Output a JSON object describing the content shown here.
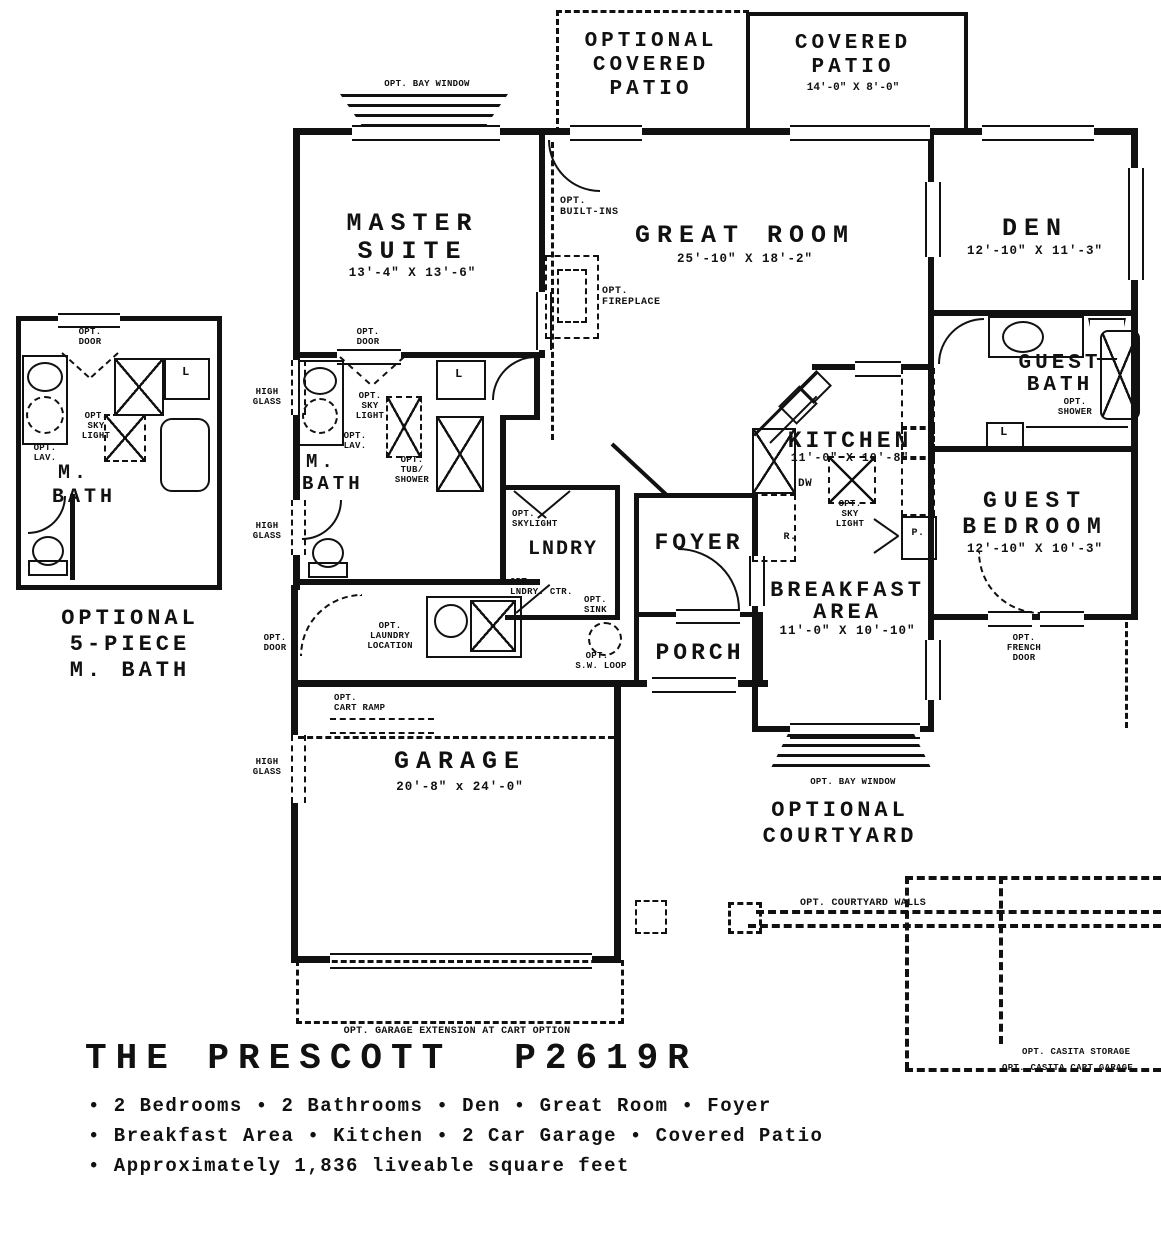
{
  "patios": {
    "optional": [
      "OPTIONAL",
      "COVERED",
      "PATIO"
    ],
    "covered": {
      "line1": "COVERED",
      "line2": "PATIO",
      "dims": "14'-0\" X 8'-0\""
    }
  },
  "rooms": {
    "master": {
      "line1": "MASTER",
      "line2": "SUITE",
      "dims": "13'-4\" X 13'-6\""
    },
    "great": {
      "name": "GREAT ROOM",
      "dims": "25'-10\" X 18'-2\""
    },
    "den": {
      "name": "DEN",
      "dims": "12'-10\" X 11'-3\""
    },
    "guest_bath": {
      "line1": "GUEST",
      "line2": "BATH"
    },
    "guest_bed": {
      "line1": "GUEST",
      "line2": "BEDROOM",
      "dims": "12'-10\" X 10'-3\""
    },
    "kitchen": {
      "name": "KITCHEN",
      "dims": "11'-0\" X 10'-8\""
    },
    "breakfast": {
      "line1": "BREAKFAST",
      "line2": "AREA",
      "dims": "11'-0\" X 10'-10\""
    },
    "foyer": {
      "name": "FOYER"
    },
    "porch": {
      "name": "PORCH"
    },
    "lndry": {
      "name": "LNDRY"
    },
    "garage": {
      "name": "GARAGE",
      "dims": "20'-8\" x 24'-0\""
    },
    "mbath": {
      "line1": "M.",
      "line2": "BATH"
    },
    "mbath_left": {
      "line1": "M.",
      "line2": "BATH"
    }
  },
  "opts": {
    "bay_window_top": "OPT. BAY WINDOW",
    "bay_window_bottom": "OPT. BAY WINDOW",
    "built_ins": [
      "OPT.",
      "BUILT-INS"
    ],
    "fireplace": [
      "OPT.",
      "FIREPLACE"
    ],
    "door": [
      "OPT.",
      "DOOR"
    ],
    "sky_light": [
      "OPT.",
      "SKY",
      "LIGHT"
    ],
    "lav": [
      "OPT.",
      "LAV."
    ],
    "tub_shower": [
      "OPT.",
      "TUB/",
      "SHOWER"
    ],
    "skylight_lndry": [
      "OPT.",
      "SKYLIGHT"
    ],
    "lndry_ctr": [
      "OPT.",
      "LNDRY. CTR."
    ],
    "sink": [
      "OPT.",
      "SINK"
    ],
    "sw_loop": [
      "OPT.",
      "S.W. LOOP"
    ],
    "shower": [
      "OPT.",
      "SHOWER"
    ],
    "french_door": [
      "OPT.",
      "FRENCH",
      "DOOR"
    ],
    "laundry_location": [
      "OPT.",
      "LAUNDRY",
      "LOCATION"
    ],
    "cart_ramp": [
      "OPT.",
      "CART RAMP"
    ],
    "garage_ext": "OPT. GARAGE EXTENSION AT CART OPTION",
    "courtyard": [
      "OPTIONAL",
      "COURTYARD"
    ],
    "courtyard_walls": "OPT. COURTYARD WALLS",
    "casita_storage": "OPT. CASITA STORAGE",
    "casita_cart": "OPT. CASITA CART GARAGE",
    "high_glass": [
      "HIGH",
      "GLASS"
    ],
    "optional_5pc": [
      "OPTIONAL",
      "5-PIECE",
      "M. BATH"
    ]
  },
  "fixtures": {
    "linen": "L",
    "dw": "DW",
    "range": "R.",
    "pantry": "P."
  },
  "footer": {
    "name": "THE PRESCOTT",
    "model": "P2619R",
    "features": [
      "• 2 Bedrooms • 2 Bathrooms • Den • Great Room • Foyer",
      "• Breakfast Area • Kitchen • 2 Car Garage • Covered Patio",
      "• Approximately 1,836 liveable square feet"
    ]
  }
}
